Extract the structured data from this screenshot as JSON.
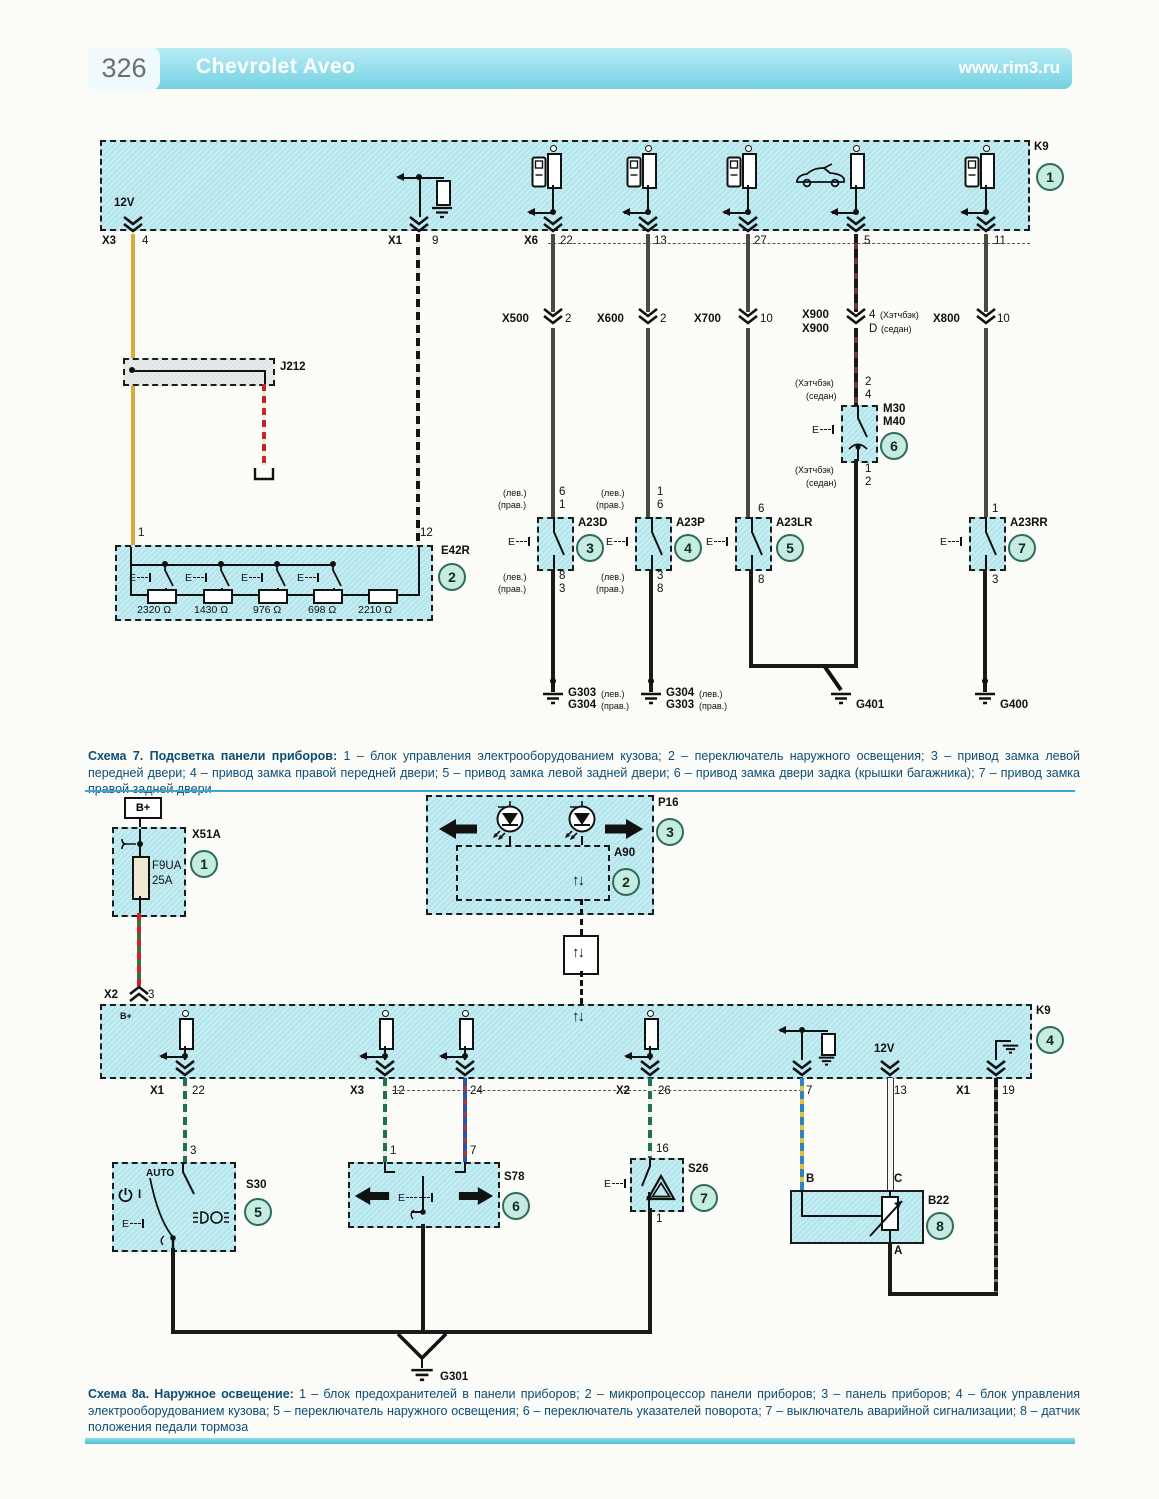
{
  "header": {
    "page": "326",
    "title": "Chevrolet Aveo",
    "url": "www.rim3.ru"
  },
  "s7": {
    "k9": "K9",
    "n1": "1",
    "v12": "12V",
    "x3": "X3",
    "p4": "4",
    "x1": "X1",
    "p9": "9",
    "x6": "X6",
    "p22": "22",
    "p13": "13",
    "p27": "27",
    "p5": "5",
    "p11": "11",
    "x500": "X500",
    "x500p": "2",
    "x600": "X600",
    "x600p": "2",
    "x700": "X700",
    "x700p": "10",
    "x900": "X900",
    "x900p": "4",
    "x900n": "(Хэтчбэк)",
    "x900dp": "D",
    "x900dn": "(седан)",
    "x800": "X800",
    "x800p": "10",
    "j212": "J212",
    "e42r": "E42R",
    "n2": "2",
    "e1": "1",
    "e12": "12",
    "r": [
      "2320 Ω",
      "1430 Ω",
      "976 Ω",
      "698 Ω",
      "2210 Ω"
    ],
    "e": "E",
    "lev": "(лев.)",
    "prav": "(прав.)",
    "hatch": "(Хэтчбэк)",
    "sedan": "(седан)",
    "a23d": "A23D",
    "n3": "3",
    "a23d_t1": "6",
    "a23d_t2": "1",
    "a23d_b1": "8",
    "a23d_b2": "3",
    "a23p": "A23P",
    "n4": "4",
    "a23p_t1": "1",
    "a23p_t2": "6",
    "a23p_b1": "3",
    "a23p_b2": "8",
    "a23lr": "A23LR",
    "n5": "5",
    "a23lr_t": "6",
    "a23lr_b": "8",
    "m30": "M30",
    "m40": "M40",
    "n6": "6",
    "m_t1": "2",
    "m_t2": "4",
    "m_b1": "1",
    "m_b2": "2",
    "a23rr": "A23RR",
    "n7": "7",
    "a23rr_t": "1",
    "a23rr_b": "3",
    "g303": "G303",
    "g304": "G304",
    "g401": "G401",
    "g400": "G400",
    "cap1": "Схема 7. Подсветка панели приборов:",
    "cap2": "1 – блок управления электрооборудованием кузова; 2 – переключатель наружного освещения; 3 – привод замка левой передней двери; 4 – привод замка правой передней двери; 5 – привод замка левой задней двери; 6 – привод замка двери задка (крышки багажника); 7 – привод замка правой задней двери"
  },
  "s8": {
    "bplus": "B+",
    "x51a": "X51A",
    "n1": "1",
    "fuse": "F9UA",
    "amp": "25A",
    "x2": "X2",
    "p3": "3",
    "bplus2": "B+",
    "p16": "P16",
    "n3": "3",
    "a90": "A90",
    "n2": "2",
    "ud": "↑↓",
    "k9": "K9",
    "n4": "4",
    "x1": "X1",
    "p22": "22",
    "x3": "X3",
    "p12": "12",
    "p24": "24",
    "x2b": "X2",
    "p26": "26",
    "p7": "7",
    "v12": "12V",
    "p13": "13",
    "x1b": "X1",
    "p19": "19",
    "s30": "S30",
    "n5": "5",
    "auto": "AUTO",
    "s30p": "3",
    "pwr": "I",
    "s78": "S78",
    "n6": "6",
    "s78p1": "1",
    "s78p7": "7",
    "s26": "S26",
    "n7": "7",
    "s26p16": "16",
    "s26p1": "1",
    "b22": "B22",
    "n8": "8",
    "b": "B",
    "c": "C",
    "a": "A",
    "g301": "G301",
    "e": "E",
    "cap1": "Схема 8а. Наружное освещение:",
    "cap2": "1 – блок предохранителей в панели приборов; 2 – микропроцессор панели приборов; 3 – панель приборов; 4 – блок управления электрооборудованием кузова; 5 – переключатель наружного освещения; 6 – переключатель указателей поворота; 7 – выключатель аварийной сигнализации; 8 – датчик положения педали тормоза"
  }
}
